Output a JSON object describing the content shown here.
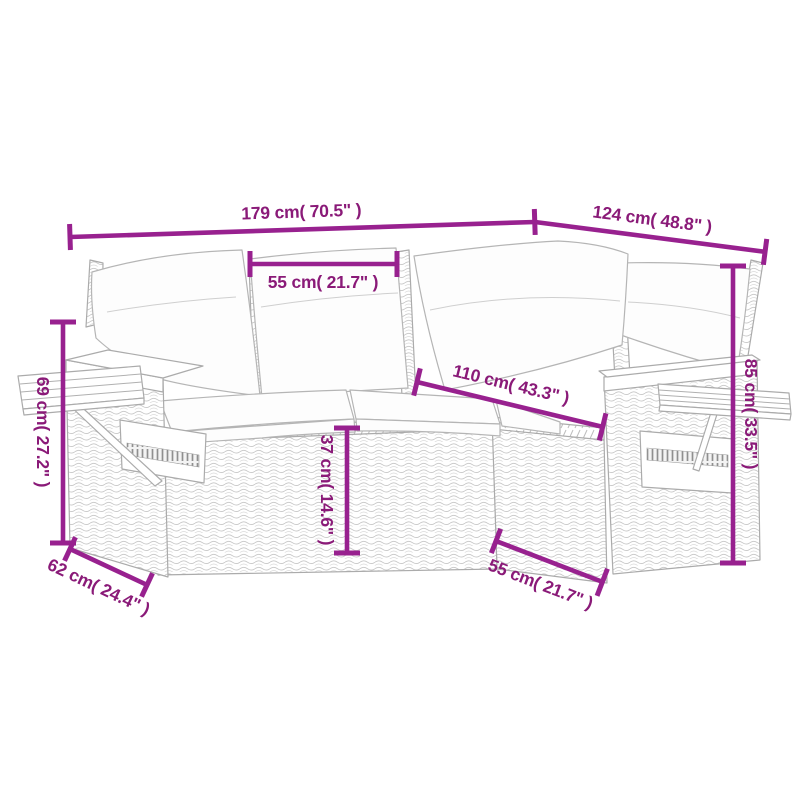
{
  "diagram": {
    "kind": "product-dimension-diagram",
    "illustration_alt": "Line drawing of an L-shaped poly rattan garden sofa with back cushions, seat cushions and fold-out side trays",
    "colors": {
      "dimension_line": "#98218F",
      "dimension_text": "#8A1A78",
      "sketch_outline": "#ABABAB",
      "cushion_fill": "#FDFDFD"
    },
    "dimensions": [
      {
        "id": "total-length",
        "label": "179 cm( 70.5\" )"
      },
      {
        "id": "side-length",
        "label": "124 cm( 48.8\" )"
      },
      {
        "id": "back-cushion-width",
        "label": "55 cm( 21.7\" )"
      },
      {
        "id": "corner-to-arm-length",
        "label": "110 cm( 43.3\" )"
      },
      {
        "id": "back-height",
        "label": "85 cm( 33.5\" )"
      },
      {
        "id": "armrest-height",
        "label": "69 cm( 27.2\" )"
      },
      {
        "id": "seat-height",
        "label": "37 cm( 14.6\" )"
      },
      {
        "id": "armrest-depth",
        "label": "62 cm( 24.4\" )"
      },
      {
        "id": "seat-depth",
        "label": "55 cm( 21.7\" )"
      }
    ]
  }
}
